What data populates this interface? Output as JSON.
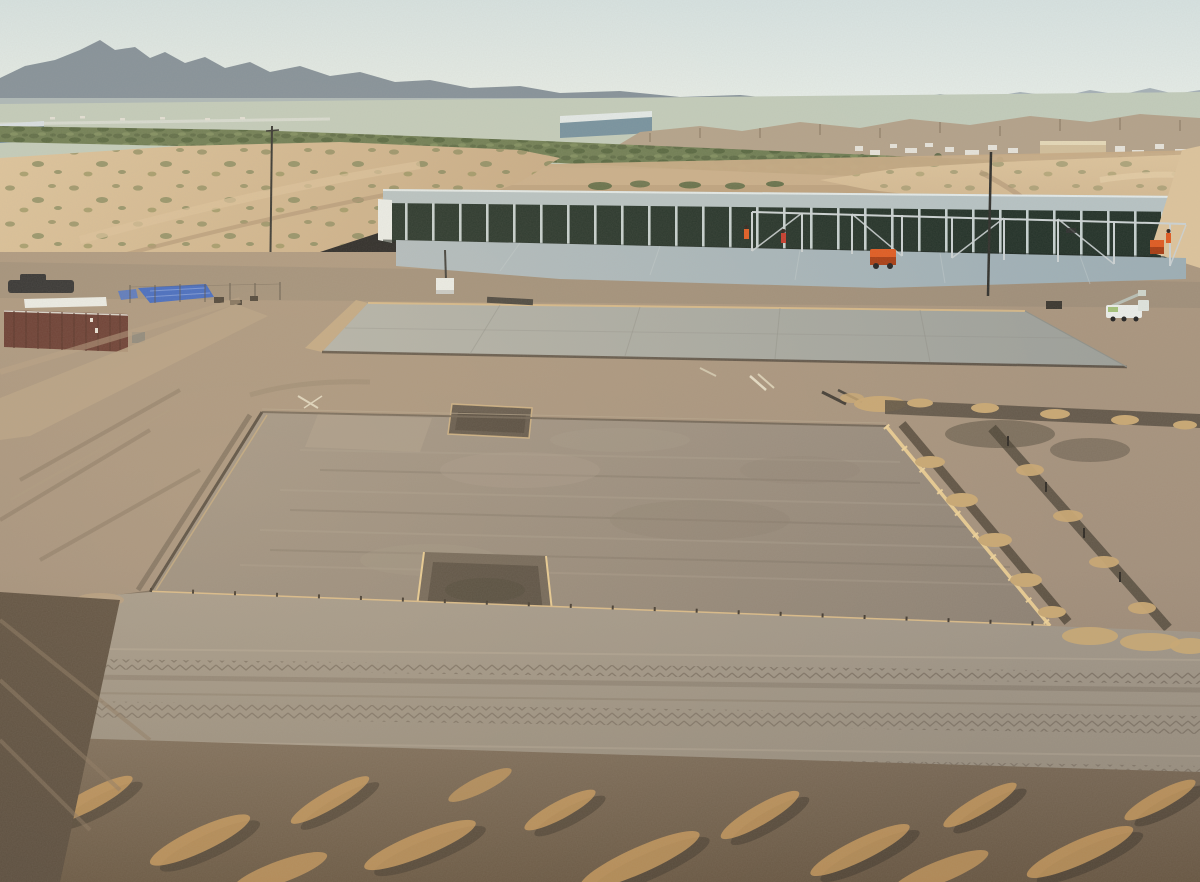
{
  "meta": {
    "type": "aerial-drone-photograph",
    "description": "Golden-hour drone photo of a desert self-storage construction site: long storage building with open bays, fresh concrete slab with steel framing being erected, a large cured slab, and a graded foundation pad with wooden forms and footing trenches, mountains and scrub valley in the distance.",
    "visible_text": ""
  },
  "objects": {
    "sky": "hazy pale desert sky",
    "mountains": "distant blue-gray mountain ranges",
    "valley": "green scrub valley floor with highway and distant town",
    "mesas": "tan eroded bluffs",
    "storage_building": "long row of storage units, dark open bays, light metal roof",
    "fresh_slab": "freshly poured light concrete slab in front of building",
    "steel_frame": "galvanized steel framing posts and braces",
    "workers": "workers in hi-vis vests",
    "orange_machine": "orange construction equipment",
    "middle_slab": "large cured gray concrete slab",
    "foundation_pad": "graded dirt pad with perimeter concrete forms",
    "form_boards": "tan lumber form boards with stakes",
    "trenches": "footing trenches with sand spoil piles",
    "shipping_container": "maroon shipping container",
    "blue_tarp": "blue tarp on ground",
    "pickup_truck": "dark pickup truck",
    "boom_truck": "white boom truck",
    "power_poles": "wooden utility poles",
    "haul_road": "dirt haul road with tire and track marks",
    "foreground_dirt": "churned dirt with golden sunlit ridges"
  },
  "colors": {
    "sky_top": "#d6e2e1",
    "sky_mid": "#e6ede8",
    "sky_bot": "#f1f2ea",
    "mtn_far": "#7b8893",
    "mtn_haze": "#9aa7ae",
    "haze": "#cdd8d2",
    "valley": "#c2ccbb",
    "scrub_bg": "#6d7c52",
    "scrub_dark": "#5c6b45",
    "scrub_light": "#7e8d5e",
    "scrub_deep": "#55663f",
    "mesa": "#b3a28a",
    "mesa_shadow": "#8d7c66",
    "sand_light": "#ddc49c",
    "sand_mid": "#c7ab85",
    "sand_dark": "#ad9273",
    "bush_a": "#8a8a5e",
    "bush_b": "#7f855a",
    "bush_c": "#95925f",
    "building_roof": "#b7c3c4",
    "roof_edge": "#e3eae9",
    "building_dark": "#223128",
    "building_post": "#c6d1d0",
    "white": "#ebeeea",
    "slab_fresh_l": "#b0bcc0",
    "slab_fresh_d": "#9caeb5",
    "steel": "#ccd3d4",
    "slab_mid_l": "#b1b2aa",
    "slab_mid_d": "#9da09a",
    "slab_joint": "#90928b",
    "dirt_l": "#ab977f",
    "dirt_m": "#a3907c",
    "dirt_d": "#8f7d6a",
    "dirt_warm": "#b69d7e",
    "pad_l": "#a09486",
    "pad_m": "#968a7c",
    "pad_d": "#8d8173",
    "pad_streak_l": "#a79b8c",
    "pad_streak_d": "#7b7063",
    "form_light": "#d9ba88",
    "form_bright": "#e8cb92",
    "form_dark": "#4f463c",
    "trench": "#4d4336",
    "sandpile": "#c9a873",
    "container": "#63352d",
    "container_rib": "#4e2a23",
    "tarp": "#3b66c4",
    "tarp_light": "#7d9ce0",
    "truck_dark": "#2b2c2e",
    "orange": "#e05a20",
    "orange_dark": "#a83c12",
    "red_orange": "#c53a2b",
    "boom_green": "#a4c27a",
    "road_l": "#a2988a",
    "road_d": "#978d7e",
    "road_track": "#5e5348",
    "bottom_l": "#7a6a58",
    "bottom_d": "#675642",
    "gold": "#c89a5c",
    "gold_dark": "#3c332a",
    "pole": "#33332f",
    "town_white": "#e6e3da",
    "town_tan": "#d2bf9b",
    "tree_green": "#4f5f3d",
    "sun_glow": "#ffdca0"
  }
}
